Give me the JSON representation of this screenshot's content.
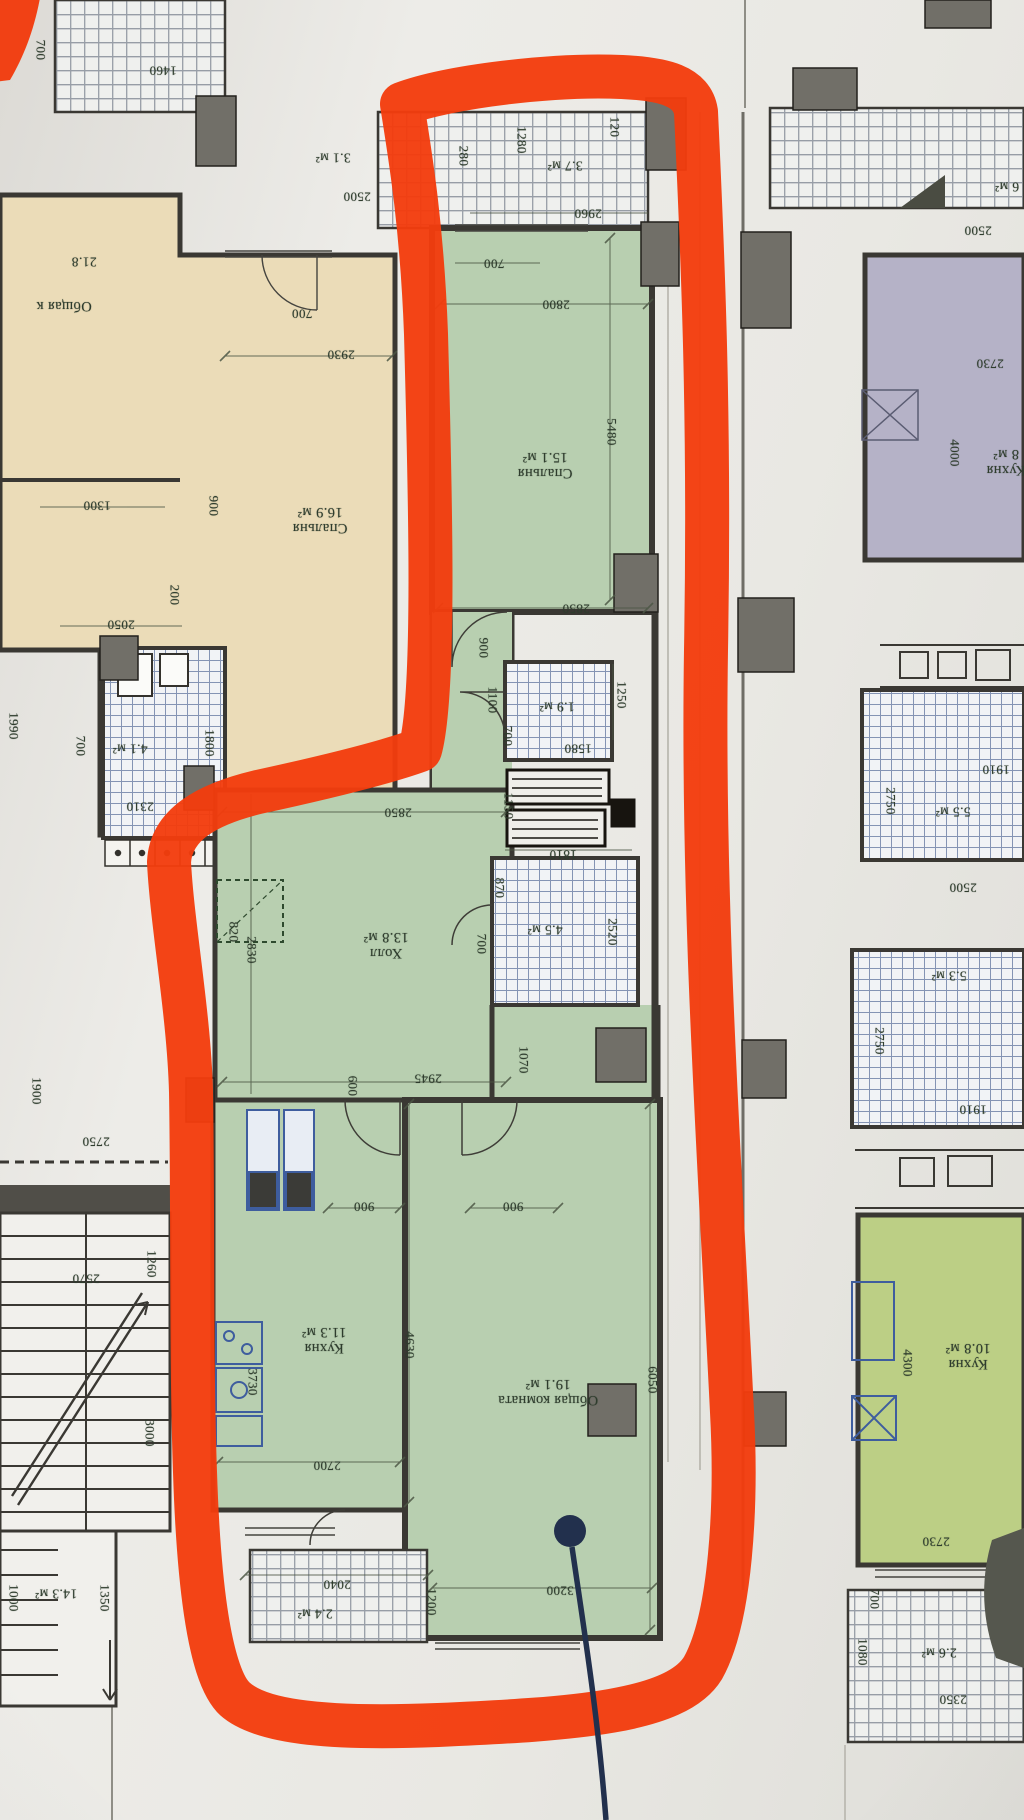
{
  "palette": {
    "paper": "#eceae5",
    "photo_bg": "#d9d7d2",
    "beige": "#ebdcb8",
    "green": "#b8cfb0",
    "lavender": "#b5b2c7",
    "lime": "#bccf85",
    "wall": "#3a3833",
    "pier": "#716f68",
    "dim_text": "#2e3c2d",
    "blue_fixture": "#3e5d9e",
    "hatch_blue": "#8494b4",
    "hatch_gray": "#979da6",
    "marker": "#f23c0e",
    "pin": "#22304d"
  },
  "plan": {
    "labels": [
      {
        "text": "2500",
        "x": 357,
        "y": 196,
        "rot": 180,
        "kind": "dim",
        "group": "center"
      },
      {
        "text": "280",
        "x": 463,
        "y": 156,
        "rot": 90,
        "kind": "dim",
        "group": "center"
      },
      {
        "text": "1280",
        "x": 521,
        "y": 140,
        "rot": 90,
        "kind": "dim",
        "group": "center"
      },
      {
        "text": "3.7 м²",
        "x": 565,
        "y": 166,
        "rot": 180,
        "kind": "area",
        "group": "center"
      },
      {
        "text": "120",
        "x": 614,
        "y": 127,
        "rot": 90,
        "kind": "dim",
        "group": "center"
      },
      {
        "text": "2960",
        "x": 588,
        "y": 213,
        "rot": 180,
        "kind": "dim",
        "group": "center"
      },
      {
        "text": "700",
        "x": 494,
        "y": 263,
        "rot": 180,
        "kind": "dim",
        "group": "center"
      },
      {
        "text": "2800",
        "x": 556,
        "y": 304,
        "rot": 180,
        "kind": "dim",
        "group": "center"
      },
      {
        "text": "5480",
        "x": 611,
        "y": 432,
        "rot": 90,
        "kind": "dim",
        "group": "center"
      },
      {
        "text": "Спальня\n15.1 м²",
        "x": 545,
        "y": 465,
        "rot": 180,
        "kind": "room",
        "group": "center"
      },
      {
        "text": "2850",
        "x": 576,
        "y": 608,
        "rot": 180,
        "kind": "dim",
        "group": "center"
      },
      {
        "text": "900",
        "x": 483,
        "y": 648,
        "rot": 90,
        "kind": "dim",
        "group": "center"
      },
      {
        "text": "1250",
        "x": 621,
        "y": 695,
        "rot": 90,
        "kind": "dim",
        "group": "center"
      },
      {
        "text": "1.9 м²",
        "x": 557,
        "y": 707,
        "rot": 180,
        "kind": "area",
        "group": "center"
      },
      {
        "text": "1100",
        "x": 492,
        "y": 700,
        "rot": 90,
        "kind": "dim",
        "group": "center"
      },
      {
        "text": "700",
        "x": 507,
        "y": 736,
        "rot": 90,
        "kind": "dim",
        "group": "center"
      },
      {
        "text": "1580",
        "x": 578,
        "y": 748,
        "rot": 180,
        "kind": "dim",
        "group": "center"
      },
      {
        "text": "2850",
        "x": 398,
        "y": 812,
        "rot": 180,
        "kind": "dim",
        "group": "center"
      },
      {
        "text": "2830",
        "x": 251,
        "y": 950,
        "rot": 90,
        "kind": "dim",
        "group": "center"
      },
      {
        "text": "1150",
        "x": 508,
        "y": 806,
        "rot": 90,
        "kind": "dim",
        "group": "center"
      },
      {
        "text": "870",
        "x": 499,
        "y": 888,
        "rot": 90,
        "kind": "dim",
        "group": "center"
      },
      {
        "text": "1810",
        "x": 563,
        "y": 854,
        "rot": 180,
        "kind": "dim",
        "group": "center"
      },
      {
        "text": "4.5 м²",
        "x": 545,
        "y": 930,
        "rot": 180,
        "kind": "area",
        "group": "center"
      },
      {
        "text": "2520",
        "x": 612,
        "y": 932,
        "rot": 90,
        "kind": "dim",
        "group": "center"
      },
      {
        "text": "Холл\n13.8 м²",
        "x": 386,
        "y": 945,
        "rot": 180,
        "kind": "room",
        "group": "center"
      },
      {
        "text": "820",
        "x": 233,
        "y": 932,
        "rot": 90,
        "kind": "dim",
        "group": "center"
      },
      {
        "text": "700",
        "x": 481,
        "y": 944,
        "rot": 90,
        "kind": "dim",
        "group": "center"
      },
      {
        "text": "1070",
        "x": 523,
        "y": 1060,
        "rot": 90,
        "kind": "dim",
        "group": "center"
      },
      {
        "text": "2945",
        "x": 428,
        "y": 1078,
        "rot": 180,
        "kind": "dim",
        "group": "center"
      },
      {
        "text": "600",
        "x": 352,
        "y": 1086,
        "rot": 90,
        "kind": "dim",
        "group": "center"
      },
      {
        "text": "900",
        "x": 364,
        "y": 1206,
        "rot": 180,
        "kind": "dim",
        "group": "center"
      },
      {
        "text": "900",
        "x": 513,
        "y": 1206,
        "rot": 180,
        "kind": "dim",
        "group": "center"
      },
      {
        "text": "4630",
        "x": 409,
        "y": 1345,
        "rot": 90,
        "kind": "dim",
        "group": "center"
      },
      {
        "text": "3730",
        "x": 252,
        "y": 1382,
        "rot": 90,
        "kind": "dim",
        "group": "center"
      },
      {
        "text": "Кухня\n11.3 м²",
        "x": 324,
        "y": 1340,
        "rot": 180,
        "kind": "room",
        "group": "center"
      },
      {
        "text": "Общая комната\n19.1 м²",
        "x": 548,
        "y": 1392,
        "rot": 180,
        "kind": "room",
        "group": "center"
      },
      {
        "text": "6050",
        "x": 652,
        "y": 1380,
        "rot": 90,
        "kind": "dim",
        "group": "center"
      },
      {
        "text": "2700",
        "x": 327,
        "y": 1465,
        "rot": 180,
        "kind": "dim",
        "group": "center"
      },
      {
        "text": "3200",
        "x": 560,
        "y": 1590,
        "rot": 180,
        "kind": "dim",
        "group": "center"
      },
      {
        "text": "2040",
        "x": 337,
        "y": 1584,
        "rot": 180,
        "kind": "dim",
        "group": "center"
      },
      {
        "text": "2.4 м²",
        "x": 315,
        "y": 1614,
        "rot": 180,
        "kind": "area",
        "group": "center"
      },
      {
        "text": "1200",
        "x": 431,
        "y": 1602,
        "rot": 90,
        "kind": "dim",
        "group": "center"
      },
      {
        "text": "1460",
        "x": 163,
        "y": 70,
        "rot": 180,
        "kind": "dim",
        "group": "left"
      },
      {
        "text": "700",
        "x": 40,
        "y": 50,
        "rot": 90,
        "kind": "dim",
        "group": "left"
      },
      {
        "text": "3.1 м²",
        "x": 333,
        "y": 158,
        "rot": 180,
        "kind": "area",
        "group": "left"
      },
      {
        "text": "Общая к",
        "x": 64,
        "y": 306,
        "rot": 180,
        "kind": "room",
        "group": "left"
      },
      {
        "text": "21.8",
        "x": 84,
        "y": 262,
        "rot": 180,
        "kind": "area",
        "group": "left"
      },
      {
        "text": "700",
        "x": 302,
        "y": 313,
        "rot": 180,
        "kind": "dim",
        "group": "left"
      },
      {
        "text": "2930",
        "x": 341,
        "y": 354,
        "rot": 180,
        "kind": "dim",
        "group": "left"
      },
      {
        "text": "Спальня\n16.9 м²",
        "x": 320,
        "y": 520,
        "rot": 180,
        "kind": "room",
        "group": "left"
      },
      {
        "text": "1300",
        "x": 97,
        "y": 505,
        "rot": 180,
        "kind": "dim",
        "group": "left"
      },
      {
        "text": "900",
        "x": 213,
        "y": 506,
        "rot": 90,
        "kind": "dim",
        "group": "left"
      },
      {
        "text": "200",
        "x": 174,
        "y": 595,
        "rot": 90,
        "kind": "dim",
        "group": "left"
      },
      {
        "text": "2050",
        "x": 121,
        "y": 624,
        "rot": 180,
        "kind": "dim",
        "group": "left"
      },
      {
        "text": "1990",
        "x": 13,
        "y": 726,
        "rot": 90,
        "kind": "dim",
        "group": "left"
      },
      {
        "text": "4.1 м²",
        "x": 130,
        "y": 749,
        "rot": 180,
        "kind": "area",
        "group": "left"
      },
      {
        "text": "700",
        "x": 80,
        "y": 746,
        "rot": 90,
        "kind": "dim",
        "group": "left"
      },
      {
        "text": "1800",
        "x": 209,
        "y": 743,
        "rot": 90,
        "kind": "dim",
        "group": "left"
      },
      {
        "text": "2310",
        "x": 140,
        "y": 806,
        "rot": 180,
        "kind": "dim",
        "group": "left"
      },
      {
        "text": "1900",
        "x": 36,
        "y": 1091,
        "rot": 90,
        "kind": "dim",
        "group": "left"
      },
      {
        "text": "2750",
        "x": 96,
        "y": 1141,
        "rot": 180,
        "kind": "dim",
        "group": "left"
      },
      {
        "text": "2570",
        "x": 86,
        "y": 1278,
        "rot": 180,
        "kind": "dim",
        "group": "left"
      },
      {
        "text": "1260",
        "x": 151,
        "y": 1264,
        "rot": 90,
        "kind": "dim",
        "group": "left"
      },
      {
        "text": "3000",
        "x": 149,
        "y": 1433,
        "rot": 90,
        "kind": "dim",
        "group": "left"
      },
      {
        "text": "14.3 м²",
        "x": 56,
        "y": 1594,
        "rot": 180,
        "kind": "area",
        "group": "left"
      },
      {
        "text": "1000",
        "x": 13,
        "y": 1598,
        "rot": 90,
        "kind": "dim",
        "group": "left"
      },
      {
        "text": "1350",
        "x": 104,
        "y": 1598,
        "rot": 90,
        "kind": "dim",
        "group": "left"
      },
      {
        "text": "6 м²",
        "x": 1007,
        "y": 187,
        "rot": 180,
        "kind": "area",
        "group": "right"
      },
      {
        "text": "2500",
        "x": 978,
        "y": 230,
        "rot": 180,
        "kind": "dim",
        "group": "right"
      },
      {
        "text": "2730",
        "x": 990,
        "y": 363,
        "rot": 180,
        "kind": "dim",
        "group": "right"
      },
      {
        "text": "4000",
        "x": 954,
        "y": 453,
        "rot": 90,
        "kind": "dim",
        "group": "right"
      },
      {
        "text": "Кухня\n8 м²",
        "x": 1006,
        "y": 462,
        "rot": 180,
        "kind": "room",
        "group": "right"
      },
      {
        "text": "1910",
        "x": 996,
        "y": 769,
        "rot": 180,
        "kind": "dim",
        "group": "right"
      },
      {
        "text": "2750",
        "x": 890,
        "y": 801,
        "rot": 90,
        "kind": "dim",
        "group": "right"
      },
      {
        "text": "5.5 м²",
        "x": 953,
        "y": 812,
        "rot": 180,
        "kind": "area",
        "group": "right"
      },
      {
        "text": "2500",
        "x": 963,
        "y": 887,
        "rot": 180,
        "kind": "dim",
        "group": "right"
      },
      {
        "text": "5.3 м²",
        "x": 949,
        "y": 976,
        "rot": 180,
        "kind": "area",
        "group": "right"
      },
      {
        "text": "2750",
        "x": 879,
        "y": 1041,
        "rot": 90,
        "kind": "dim",
        "group": "right"
      },
      {
        "text": "1910",
        "x": 973,
        "y": 1109,
        "rot": 180,
        "kind": "dim",
        "group": "right"
      },
      {
        "text": "4300",
        "x": 907,
        "y": 1363,
        "rot": 90,
        "kind": "dim",
        "group": "right"
      },
      {
        "text": "Кухня\n10.8 м²",
        "x": 968,
        "y": 1356,
        "rot": 180,
        "kind": "room",
        "group": "right"
      },
      {
        "text": "2730",
        "x": 936,
        "y": 1541,
        "rot": 180,
        "kind": "dim",
        "group": "right"
      },
      {
        "text": "700",
        "x": 874,
        "y": 1599,
        "rot": 90,
        "kind": "dim",
        "group": "right"
      },
      {
        "text": "1080",
        "x": 862,
        "y": 1652,
        "rot": 90,
        "kind": "dim",
        "group": "right"
      },
      {
        "text": "2.6 м²",
        "x": 939,
        "y": 1653,
        "rot": 180,
        "kind": "area",
        "group": "right"
      },
      {
        "text": "2350",
        "x": 953,
        "y": 1699,
        "rot": 180,
        "kind": "dim",
        "group": "right"
      }
    ]
  }
}
